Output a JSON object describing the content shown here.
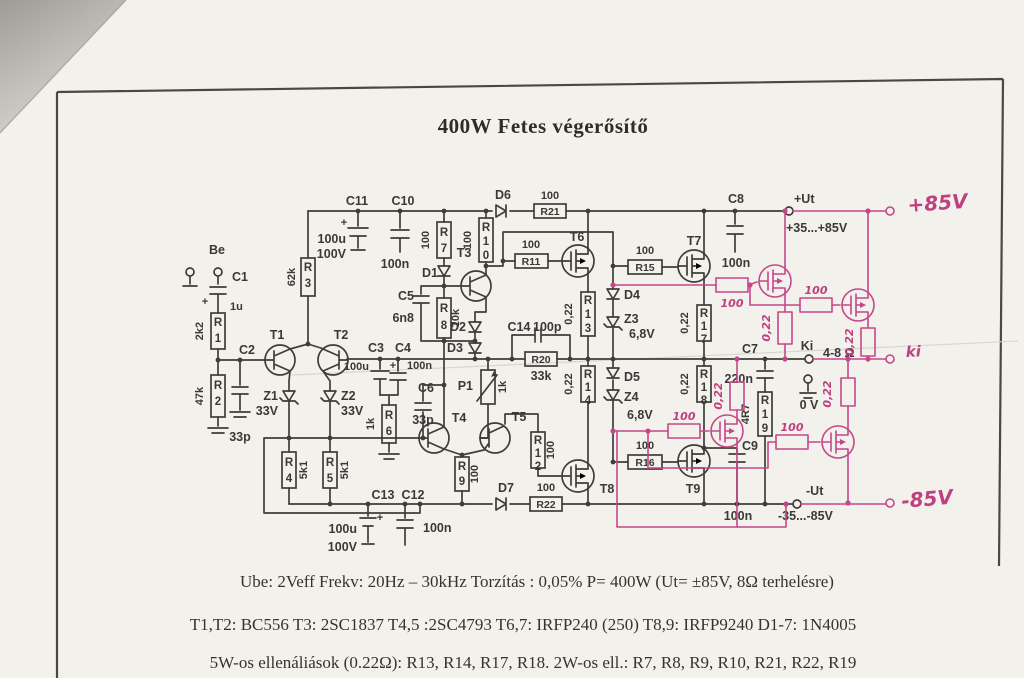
{
  "colors": {
    "ink": "#3e3d3a",
    "annotation_pink": "#c5478b",
    "paper": "#f3f1ec"
  },
  "title": "400W Fetes végerősítő",
  "specs": {
    "line1": "Ube: 2Veff   Frekv: 20Hz – 30kHz   Torzítás : 0,05%  P= 400W (Ut= ±85V,   8Ω  terhelésre)",
    "line2": "T1,T2: BC556   T3: 2SC1837   T4,5 :2SC4793   T6,7: IRFP240 (250)   T8,9: IRFP9240   D1-7: 1N4005",
    "line3": "5W-os ellenáliások (0.22Ω): R13, R14, R17, R18.    2W-os ell.: R7, R8, R9, R10, R21, R22, R19"
  },
  "labels": {
    "be": "Be",
    "c1": "C1",
    "c1v": "1u",
    "plus": "+",
    "r1": "R1",
    "r1v": "2k2",
    "r2": "R2",
    "r2v": "47k",
    "c2": "C2",
    "c2v": "33p",
    "t1": "T1",
    "t2": "T2",
    "z1": "Z1",
    "z1v": "33V",
    "z2": "Z2",
    "z2v": "33V",
    "r4": "R4",
    "r4v": "5k1",
    "r5": "R5",
    "r5v": "5k1",
    "r3": "R3",
    "r3v": "62k",
    "c11": "C11",
    "c11v1": "100u",
    "c11v2": "100V",
    "c10": "C10",
    "c10v": "100n",
    "c3": "C3",
    "c3v": "100u",
    "c4": "C4",
    "c4v": "100n",
    "r6": "R6",
    "r6v": "1k",
    "c6": "C6",
    "c6v": "33p",
    "t4": "T4",
    "t5": "T5",
    "p1": "P1",
    "p1v": "1k",
    "r9": "R9",
    "r9v": "100",
    "c13": "C13",
    "c13v1": "100u",
    "c13v2": "100V",
    "c12": "C12",
    "c12v": "100n",
    "d7": "D7",
    "r22": "R22",
    "r22v": "100",
    "r7": "R7",
    "r7v": "100",
    "r10": "R10",
    "r10v": "100",
    "d1": "D1",
    "t3": "T3",
    "c5": "C5",
    "c5v": "6n8",
    "r8": "R8",
    "r8v": "10k",
    "d2": "D2",
    "d3": "D3",
    "d6": "D6",
    "r21": "R21",
    "r21v": "100",
    "r11": "R11",
    "r11v": "100",
    "t6": "T6",
    "r15": "R15",
    "r15v": "100",
    "t7": "T7",
    "c8": "C8",
    "c8v": "100n",
    "r13": "R13",
    "r13v": "0,22",
    "d4": "D4",
    "z3": "Z3",
    "z3v": "6,8V",
    "r17": "R17",
    "r17v": "0,22",
    "r14": "R14",
    "r14v": "0,22",
    "d5": "D5",
    "z4": "Z4",
    "z4v": "6,8V",
    "r18": "R18",
    "r18v": "0,22",
    "c14": "C14",
    "c14v": "100p",
    "r20": "R20",
    "r20v": "33k",
    "r12": "R12",
    "r12v": "100",
    "t8": "T8",
    "r16": "R16",
    "r16v": "100",
    "t9": "T9",
    "c9": "C9",
    "c9v": "100n",
    "c7": "C7",
    "c7v": "220n",
    "r19": "R19",
    "r19v": "4R7",
    "ki": "Ki",
    "load": "4-8 Ω",
    "gnd": "0 V",
    "vplus": "+Ut",
    "vplus_range": "+35...+85V",
    "vminus": "-Ut",
    "vminus_range": "-35...-85V"
  },
  "annotations": {
    "vplus": "+85V",
    "output": "ki",
    "vminus": "-85V",
    "gate_r": "100",
    "source_r": "0,22"
  }
}
